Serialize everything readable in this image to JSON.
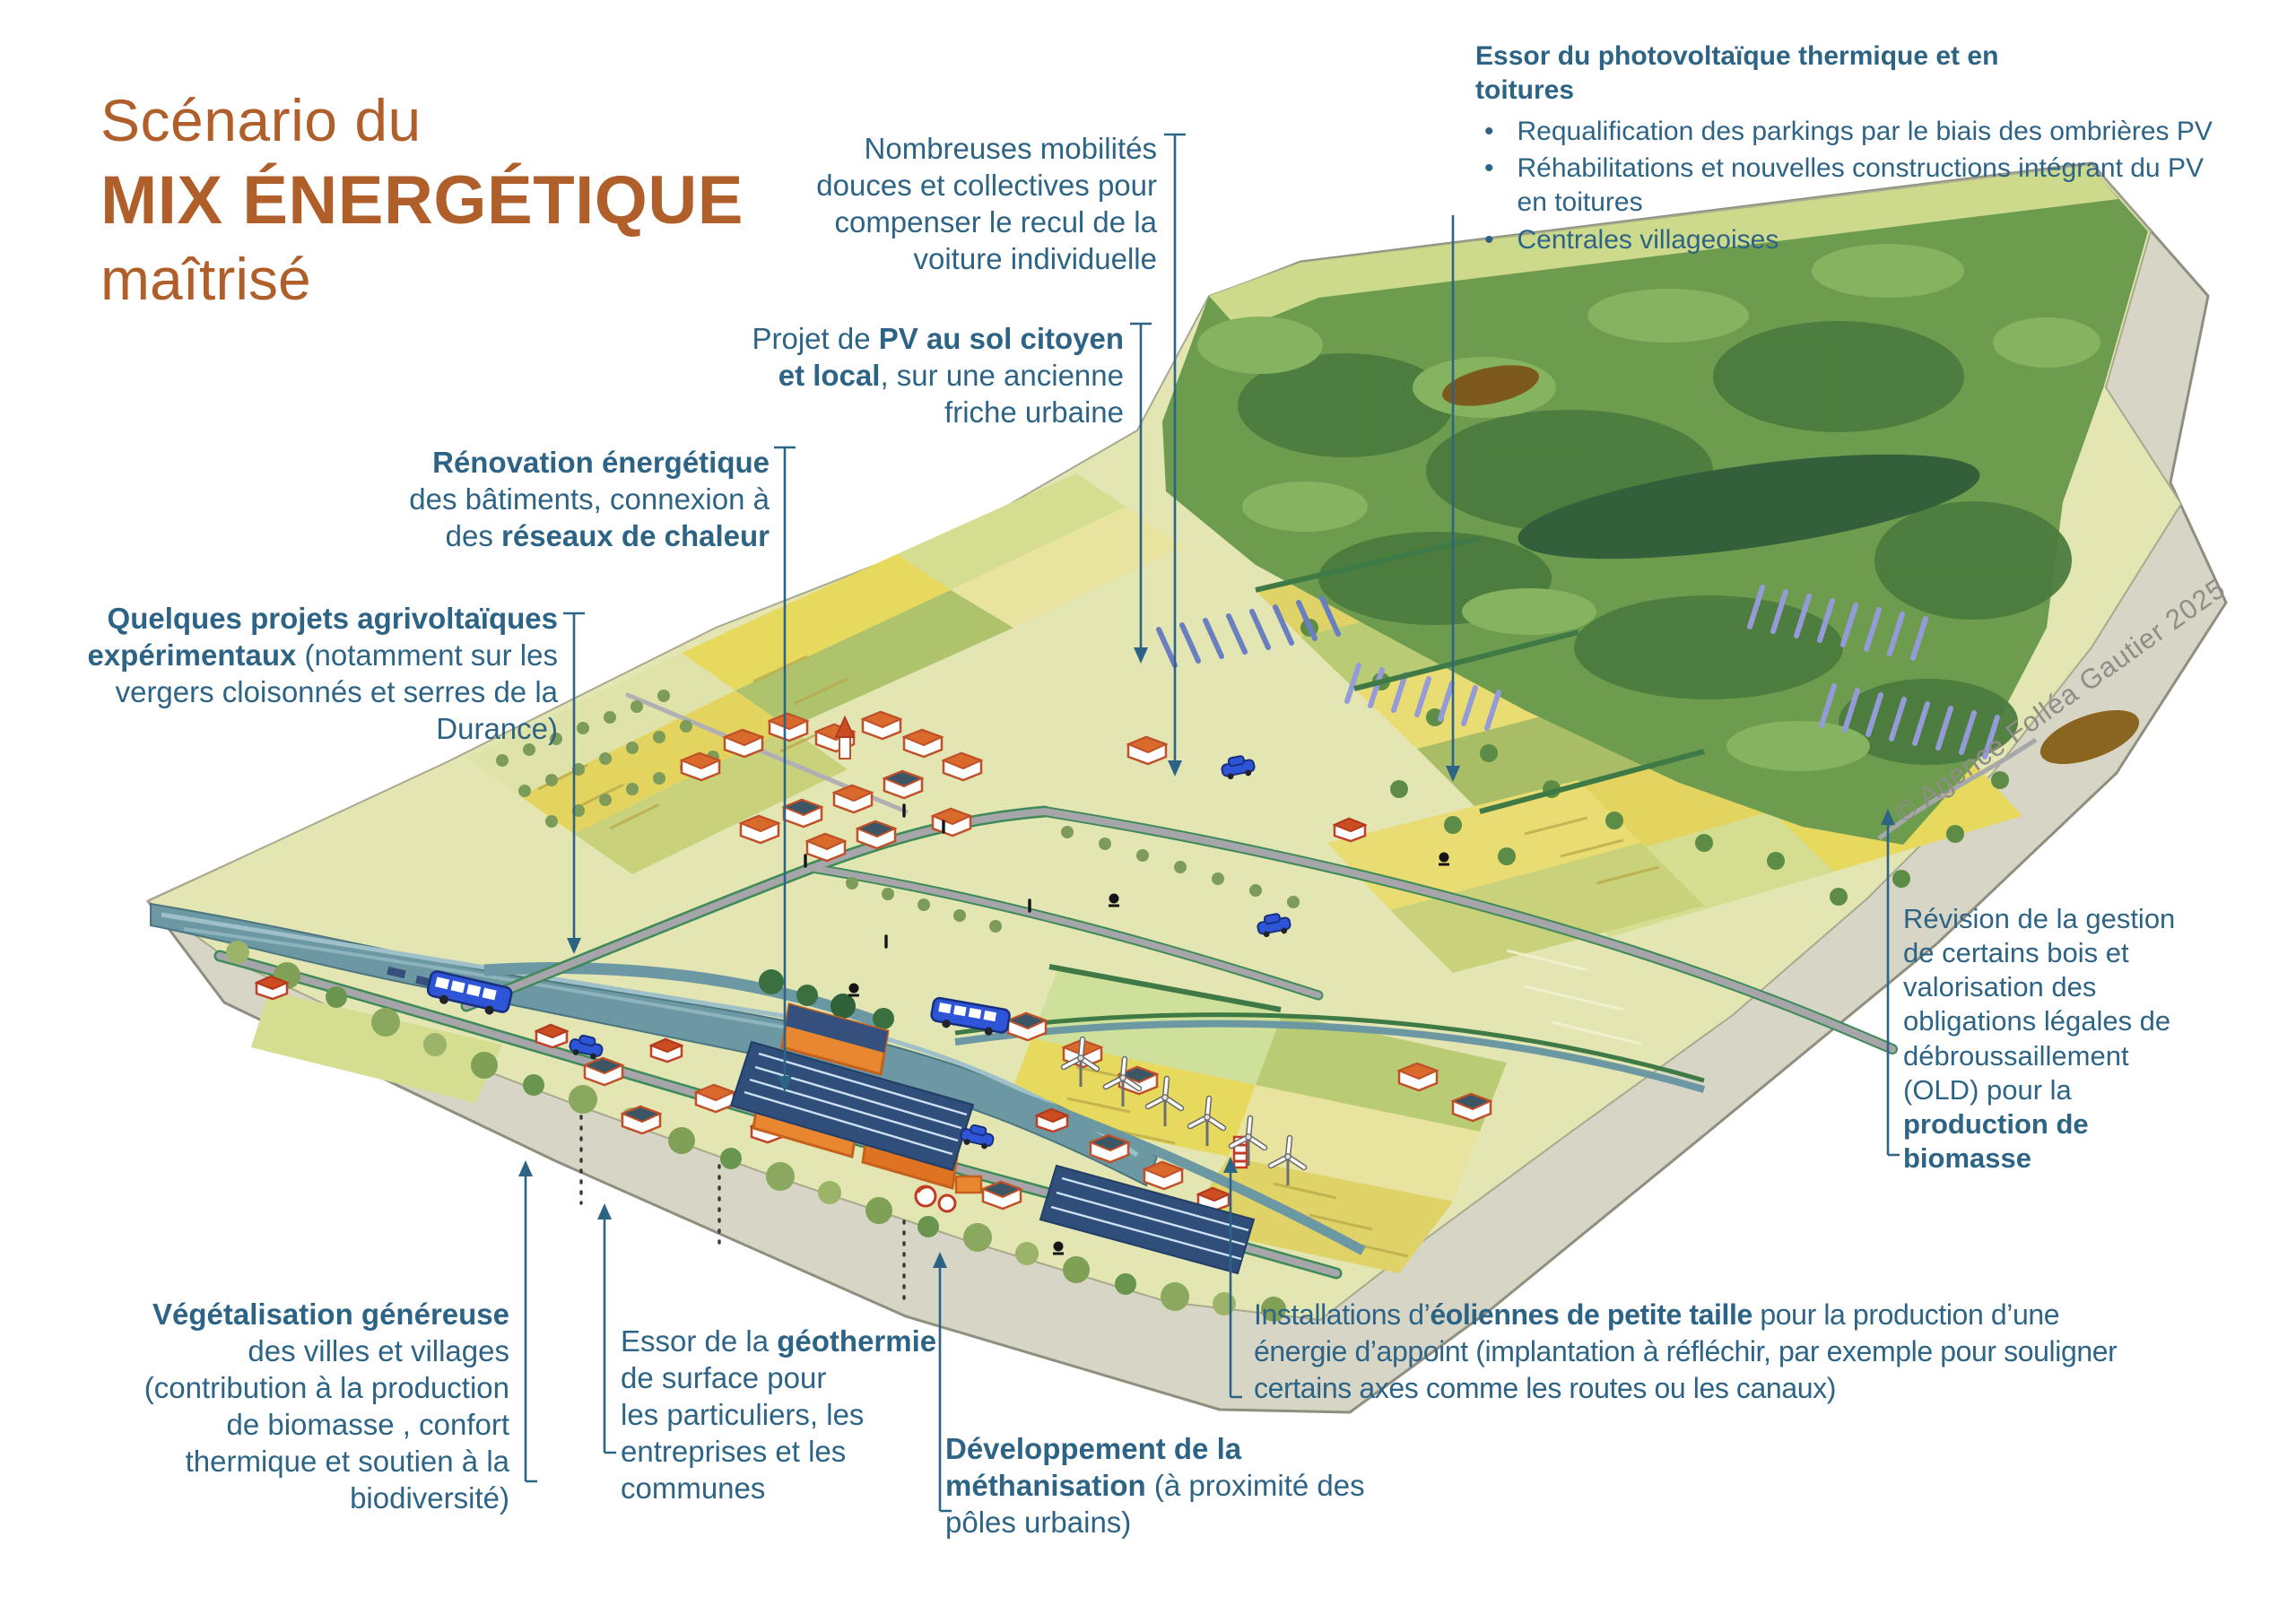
{
  "title": {
    "line1": "Scénario du",
    "line2": "MIX ÉNERGÉTIQUE",
    "line3": "maîtrisé"
  },
  "copyright": {
    "text": "© Agence Folléa Gautier 2025"
  },
  "colors": {
    "accent_orange": "#b05f2b",
    "annotation_blue": "#2d6486",
    "copyright_gray": "#8e8d86",
    "forest_green": "#6d9c4e",
    "field_yellow": "#e6d95e",
    "river_teal": "#6b98a2",
    "cliff_gray": "#d6d5c6",
    "pv_blue": "#2f4f7a",
    "roof_orange": "#d96a2b"
  },
  "annotations": {
    "mobilites": {
      "lines": [
        [
          {
            "t": "Nombreuses mobilités"
          }
        ],
        [
          {
            "t": "douces et collectives pour"
          }
        ],
        [
          {
            "t": "compenser le recul de la"
          }
        ],
        [
          {
            "t": "voiture individuelle"
          }
        ]
      ]
    },
    "pv_sol": {
      "lines": [
        [
          {
            "t": "Projet de "
          },
          {
            "t": "PV au sol citoyen",
            "b": 1
          }
        ],
        [
          {
            "t": "et local",
            "b": 1
          },
          {
            "t": ", sur une ancienne"
          }
        ],
        [
          {
            "t": "friche urbaine"
          }
        ]
      ]
    },
    "renovation": {
      "lines": [
        [
          {
            "t": "Rénovation énergétique",
            "b": 1
          }
        ],
        [
          {
            "t": "des bâtiments, connexion à"
          }
        ],
        [
          {
            "t": "des "
          },
          {
            "t": "réseaux de chaleur",
            "b": 1
          }
        ]
      ]
    },
    "agrivoltaique": {
      "lines": [
        [
          {
            "t": "Quelques projets agrivoltaïques",
            "b": 1
          }
        ],
        [
          {
            "t": "expérimentaux",
            "b": 1
          },
          {
            "t": " (notamment sur les"
          }
        ],
        [
          {
            "t": "vergers cloisonnés et serres de la"
          }
        ],
        [
          {
            "t": "Durance)"
          }
        ]
      ]
    },
    "essor_pv": {
      "heading": [
        [
          {
            "t": "Essor du photovoltaïque thermique et en",
            "b": 1
          }
        ],
        [
          {
            "t": "toitures",
            "b": 1
          }
        ]
      ],
      "bullet_char": "•",
      "bullets": [
        [
          [
            {
              "t": "Requalification des parkings par le biais des ombrières PV"
            }
          ]
        ],
        [
          [
            {
              "t": "Réhabilitations et nouvelles constructions intégrant du PV"
            }
          ],
          [
            {
              "t": "en toitures"
            }
          ]
        ],
        [
          [
            {
              "t": "Centrales villageoises"
            }
          ]
        ]
      ]
    },
    "revision": {
      "lines": [
        [
          {
            "t": "Révision de la gestion"
          }
        ],
        [
          {
            "t": "de certains bois et"
          }
        ],
        [
          {
            "t": "valorisation des"
          }
        ],
        [
          {
            "t": "obligations légales de"
          }
        ],
        [
          {
            "t": "débroussaillement"
          }
        ],
        [
          {
            "t": "(OLD) pour la"
          }
        ],
        [
          {
            "t": "production de",
            "b": 1
          }
        ],
        [
          {
            "t": "biomasse",
            "b": 1
          }
        ]
      ]
    },
    "vegetalisation": {
      "lines": [
        [
          {
            "t": "Végétalisation généreuse",
            "b": 1
          }
        ],
        [
          {
            "t": "des villes et villages"
          }
        ],
        [
          {
            "t": "(contribution à la production"
          }
        ],
        [
          {
            "t": "de biomasse , confort"
          }
        ],
        [
          {
            "t": "thermique et soutien à la"
          }
        ],
        [
          {
            "t": "biodiversité)"
          }
        ]
      ]
    },
    "geothermie": {
      "lines": [
        [
          {
            "t": "Essor de la "
          },
          {
            "t": "géothermie",
            "b": 1
          }
        ],
        [
          {
            "t": "de surface pour"
          }
        ],
        [
          {
            "t": "les particuliers, les"
          }
        ],
        [
          {
            "t": "entreprises et les"
          }
        ],
        [
          {
            "t": "communes"
          }
        ]
      ]
    },
    "methanisation": {
      "lines": [
        [
          {
            "t": "Développement de la",
            "b": 1
          }
        ],
        [
          {
            "t": "méthanisation",
            "b": 1
          },
          {
            "t": " (à proximité des"
          }
        ],
        [
          {
            "t": "pôles urbains)"
          }
        ]
      ]
    },
    "eoliennes": {
      "lines": [
        [
          {
            "t": "Installations d’"
          },
          {
            "t": "éoliennes de petite taille",
            "b": 1
          },
          {
            "t": "  pour la production d’une"
          }
        ],
        [
          {
            "t": "énergie d’appoint (implantation à réfléchir, par exemple pour souligner"
          }
        ],
        [
          {
            "t": "certains axes comme les routes ou les canaux)"
          }
        ]
      ]
    }
  }
}
